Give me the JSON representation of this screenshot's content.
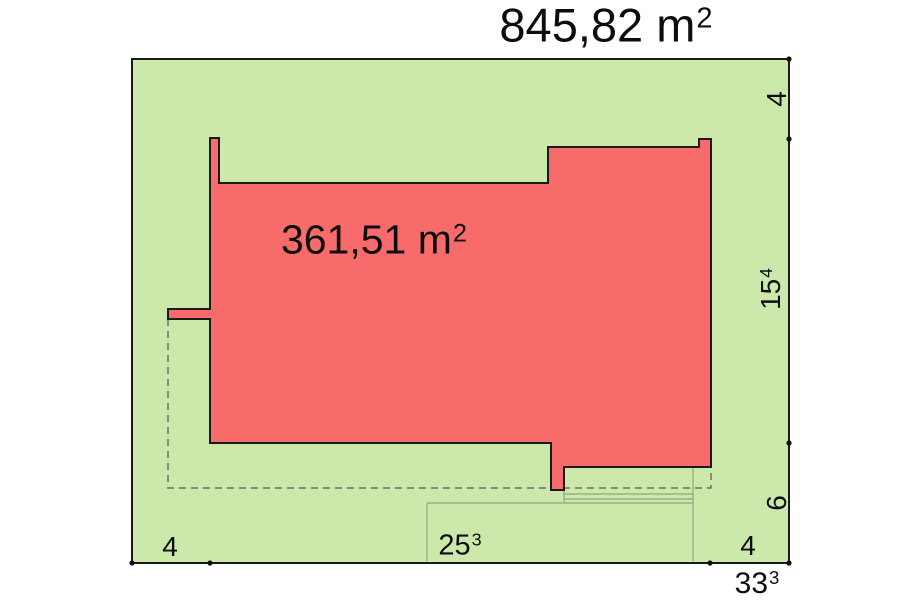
{
  "plot": {
    "fill": "#cde8ab",
    "area_text": "845,82 m",
    "area_sup": "2"
  },
  "building": {
    "fill": "#f76b6b",
    "area_text": "361,51 m",
    "area_sup": "2"
  },
  "dims": {
    "bottom_left": "4",
    "bottom_mid_text": "25",
    "bottom_mid_sup": "3",
    "bottom_right": "4",
    "bottom_total_text": "33",
    "bottom_total_sup": "3",
    "right_top": "4",
    "right_mid_text": "15",
    "right_mid_sup": "4",
    "right_bottom": "6"
  },
  "colors": {
    "outline": "#1a1a1a",
    "dashed_outline": "#6e6e66",
    "terrace_lines": "#94a57f",
    "tick": "#111111"
  }
}
